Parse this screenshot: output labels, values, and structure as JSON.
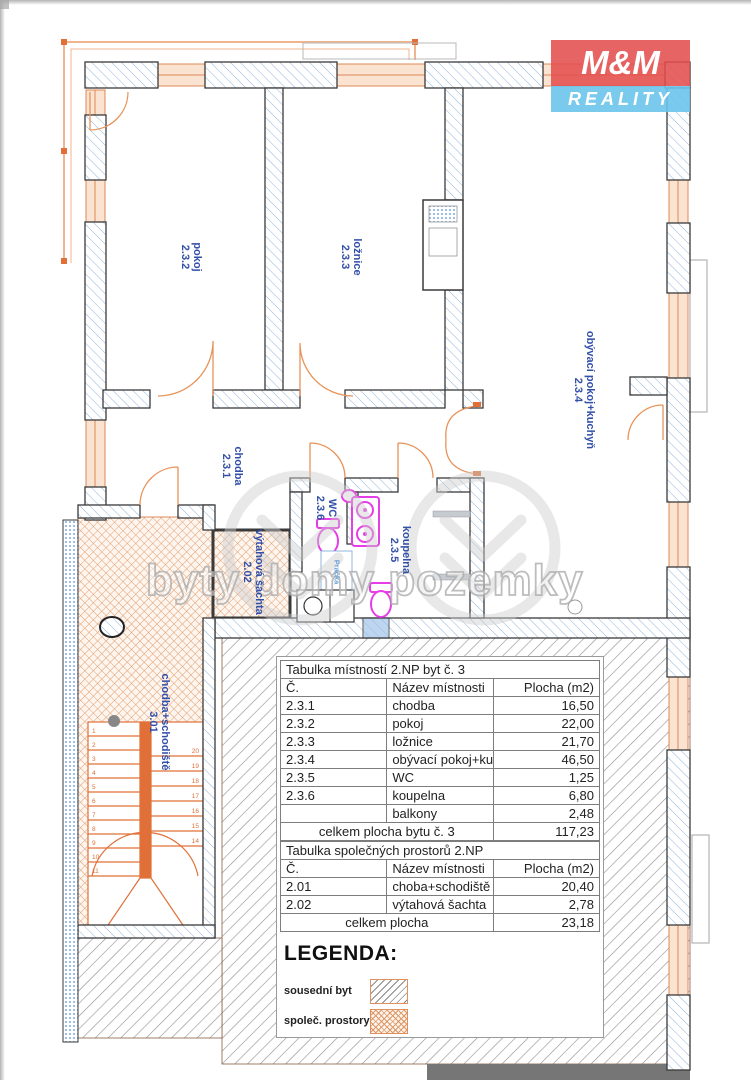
{
  "page": {
    "watermark_text": "byty domy pozemky"
  },
  "logo": {
    "top": "M&M",
    "bottom": "REALITY"
  },
  "plan": {
    "rooms": [
      {
        "name": "pokoj",
        "number": "2.3.2"
      },
      {
        "name": "ložnice",
        "number": "2.3.3"
      },
      {
        "name": "obývací pokoj+kuchyň",
        "number": "2.3.4"
      },
      {
        "name": "chodba",
        "number": "2.3.1"
      },
      {
        "name": "WC",
        "number": "2.3.6"
      },
      {
        "name": "koupelna",
        "number": "2.3.5"
      },
      {
        "name": "výtahová šachta",
        "number": "2.02"
      },
      {
        "name": "chodba+schodiště",
        "number": "3.01"
      }
    ],
    "appliance_label": "Pračka",
    "stairs": {
      "left_numbers": [
        "1",
        "2",
        "3",
        "4",
        "5",
        "6",
        "7",
        "8",
        "9",
        "10",
        "11"
      ],
      "right_numbers": [
        "20",
        "19",
        "18",
        "17",
        "16",
        "15",
        "14"
      ]
    }
  },
  "tables": [
    {
      "title": "Tabulka místností 2.NP byt č. 3",
      "headers": [
        "Č.",
        "Název místnosti",
        "Plocha (m2)"
      ],
      "rows": [
        [
          "2.3.1",
          "chodba",
          "16,50"
        ],
        [
          "2.3.2",
          "pokoj",
          "22,00"
        ],
        [
          "2.3.3",
          "ložnice",
          "21,70"
        ],
        [
          "2.3.4",
          "obývací pokoj+kuchyň",
          "46,50"
        ],
        [
          "2.3.5",
          "WC",
          "1,25"
        ],
        [
          "2.3.6",
          "koupelna",
          "6,80"
        ],
        [
          "",
          "balkony",
          "2,48"
        ]
      ],
      "total_label": "celkem plocha bytu č. 3",
      "total_value": "117,23"
    },
    {
      "title": "Tabulka společných prostorů 2.NP",
      "headers": [
        "Č.",
        "Název místnosti",
        "Plocha (m2)"
      ],
      "rows": [
        [
          "2.01",
          "choba+schodiště",
          "20,40"
        ],
        [
          "2.02",
          "výtahová šachta",
          "2,78"
        ]
      ],
      "total_label": "celkem plocha",
      "total_value": "23,18"
    }
  ],
  "legend": {
    "title": "LEGENDA:",
    "items": [
      {
        "label": "sousední byt",
        "pattern": "diagonal-gray"
      },
      {
        "label": "společ. prostory",
        "pattern": "cross-orange"
      }
    ]
  },
  "colors": {
    "label_blue": "#3350a8",
    "plan_orange": "#e07038",
    "fixture_magenta": "#e63ee6",
    "logo_red": "#e34d4d",
    "logo_blue": "#6cc4ec",
    "wall_hatch_blue": "#8fb4dd",
    "neighbor_hatch_gray": "#8a8a8a",
    "common_hatch_orange": "#dd9766"
  }
}
